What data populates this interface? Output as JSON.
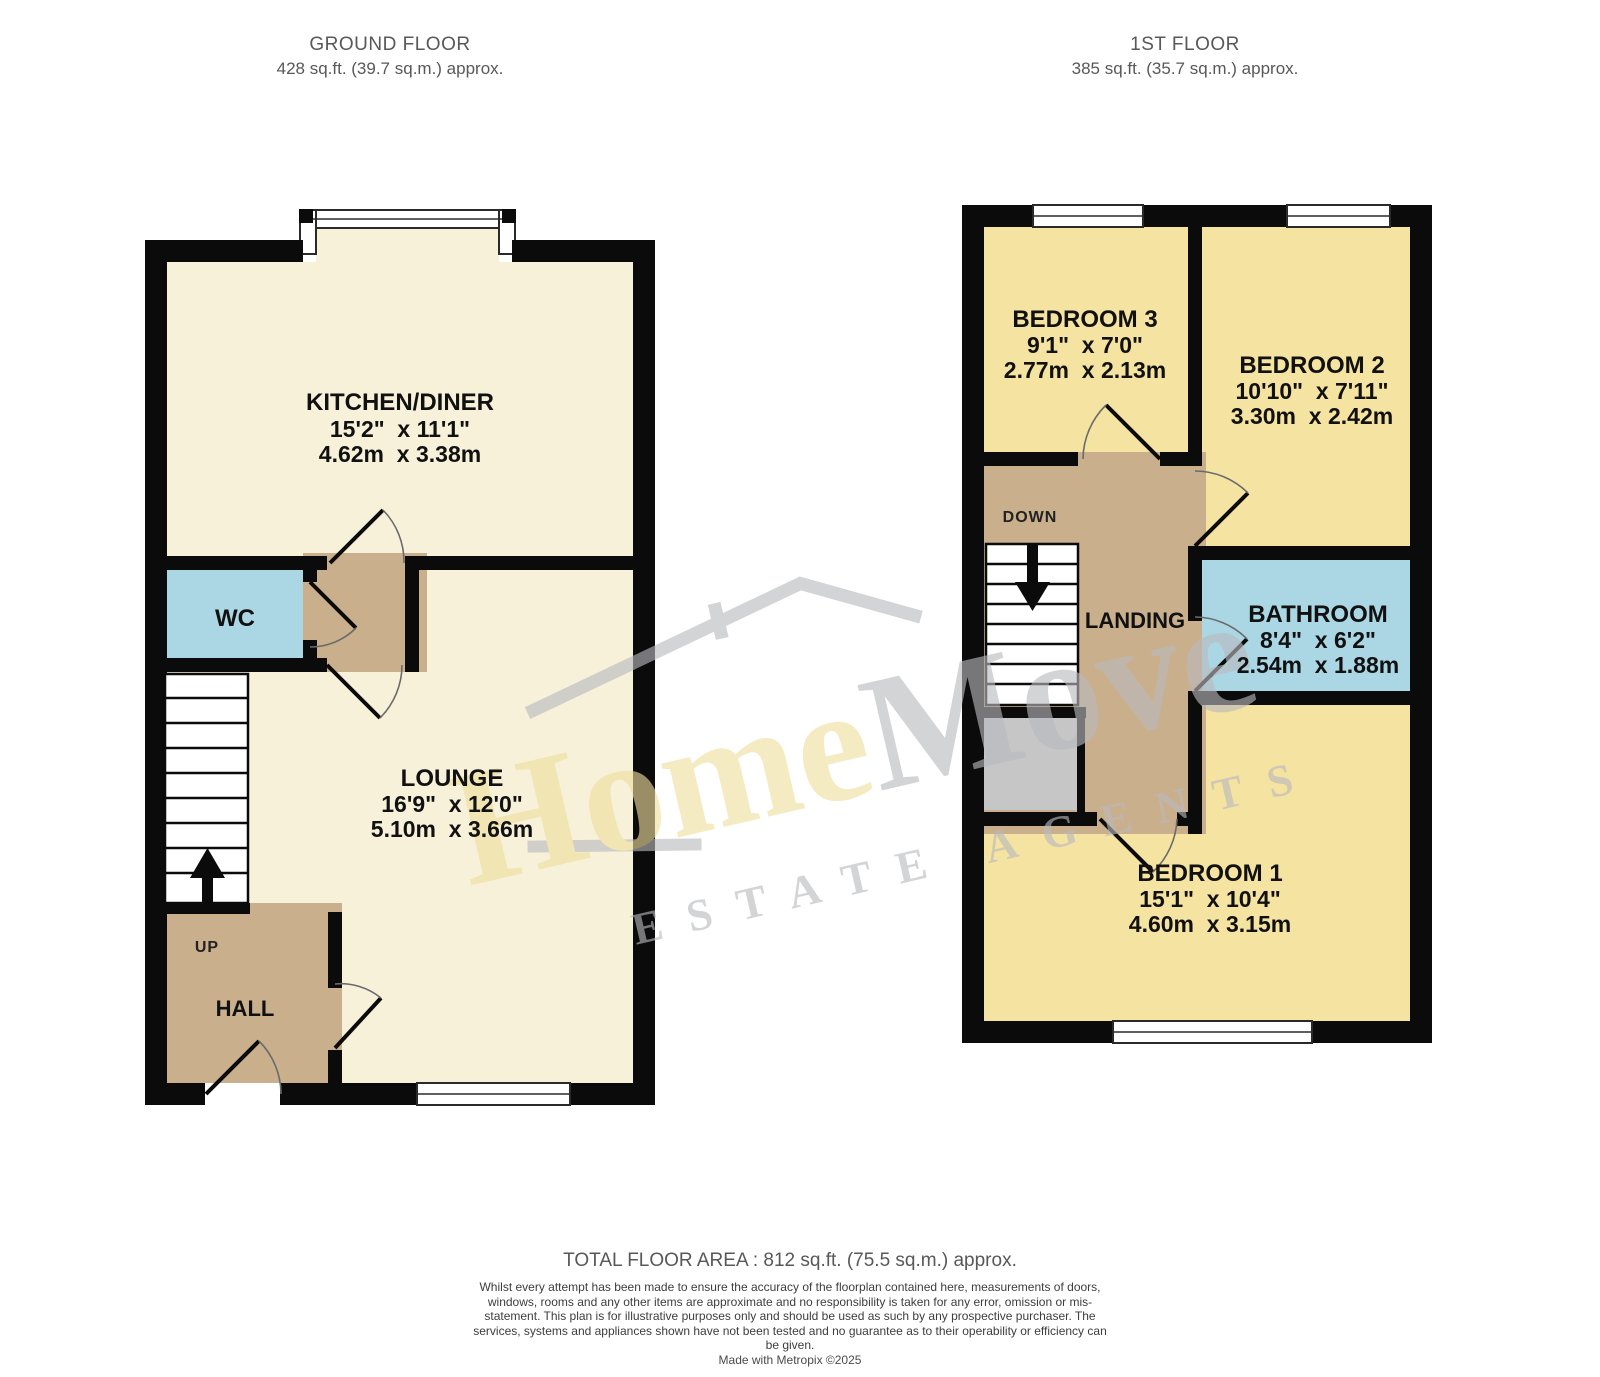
{
  "header": {
    "ground": {
      "title": "GROUND FLOOR",
      "area": "428 sq.ft. (39.7 sq.m.) approx."
    },
    "first": {
      "title": "1ST FLOOR",
      "area": "385 sq.ft. (35.7 sq.m.) approx."
    }
  },
  "ground_floor": {
    "rooms": {
      "kitchen": {
        "name": "KITCHEN/DINER",
        "imperial": "15'2\"  x 11'1\"",
        "metric": "4.62m  x 3.38m"
      },
      "wc": {
        "name": "WC"
      },
      "lounge": {
        "name": "LOUNGE",
        "imperial": "16'9\"  x 12'0\"",
        "metric": "5.10m  x 3.66m"
      },
      "hall": {
        "name": "HALL"
      },
      "stairs_label": "UP"
    }
  },
  "first_floor": {
    "rooms": {
      "bedroom3": {
        "name": "BEDROOM 3",
        "imperial": "9'1\"  x 7'0\"",
        "metric": "2.77m  x 2.13m"
      },
      "bedroom2": {
        "name": "BEDROOM 2",
        "imperial": "10'10\"  x 7'11\"",
        "metric": "3.30m  x 2.42m"
      },
      "bathroom": {
        "name": "BATHROOM",
        "imperial": "8'4\"  x 6'2\"",
        "metric": "2.54m  x 1.88m"
      },
      "bedroom1": {
        "name": "BEDROOM 1",
        "imperial": "15'1\"  x 10'4\"",
        "metric": "4.60m  x 3.15m"
      },
      "landing": {
        "name": "LANDING"
      },
      "stairs_label": "DOWN"
    }
  },
  "watermark": {
    "brand_home": "Home",
    "brand_move": "Move",
    "tagline": "ESTATE AGENTS"
  },
  "footer": {
    "total": "TOTAL FLOOR AREA : 812 sq.ft. (75.5 sq.m.) approx.",
    "disclaimer": "Whilst every attempt has been made to ensure the accuracy of the floorplan contained here, measurements of doors, windows, rooms and any other items are approximate and no responsibility is taken for any error, omission or mis-statement. This plan is for illustrative purposes only and should be used as such by any prospective purchaser. The services, systems and appliances shown have not been tested and no guarantee as to their operability or efficiency can be given.",
    "credit": "Made with Metropix ©2025"
  },
  "palette": {
    "room_cream": "#F7F1DA",
    "room_yellow": "#F5E3A2",
    "room_blue": "#ABD7E4",
    "circulation_tan": "#C9AF8B",
    "cupboard_gray": "#C6C6C6",
    "wall_black": "#0B0B0B",
    "watermark_gold": "#F0DF9E",
    "watermark_gray": "#B9BABE"
  }
}
